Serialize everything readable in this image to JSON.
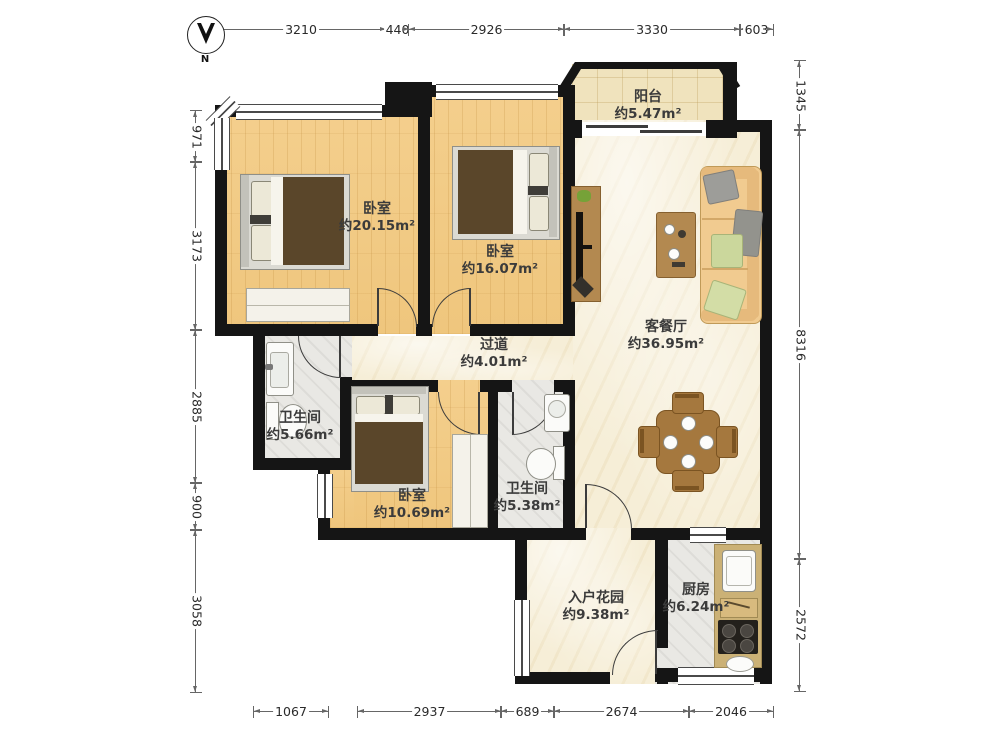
{
  "compass": {
    "label": "N"
  },
  "dimensions": {
    "top": [
      "3210",
      "440",
      "2926",
      "3330",
      "603"
    ],
    "left": [
      "971",
      "3173",
      "2885",
      "900",
      "3058"
    ],
    "right": [
      "1345",
      "8316",
      "2572"
    ],
    "bottom": [
      "1067",
      "2937",
      "689",
      "2674",
      "2046"
    ]
  },
  "rooms": [
    {
      "id": "balcony",
      "name": "阳台",
      "area": "约5.47m²"
    },
    {
      "id": "bedroom-master",
      "name": "卧室",
      "area": "约20.15m²"
    },
    {
      "id": "bedroom-second",
      "name": "卧室",
      "area": "约16.07m²"
    },
    {
      "id": "living-dining",
      "name": "客餐厅",
      "area": "约36.95m²"
    },
    {
      "id": "hallway",
      "name": "过道",
      "area": "约4.01m²"
    },
    {
      "id": "bathroom-main",
      "name": "卫生间",
      "area": "约5.66m²"
    },
    {
      "id": "bedroom-third",
      "name": "卧室",
      "area": "约10.69m²"
    },
    {
      "id": "bathroom-second",
      "name": "卫生间",
      "area": "约5.38m²"
    },
    {
      "id": "entry-garden",
      "name": "入户花园",
      "area": "约9.38m²"
    },
    {
      "id": "kitchen",
      "name": "厨房",
      "area": "约6.24m²"
    }
  ],
  "palette": {
    "wall": "#151515",
    "wood_floor": "#f3cd87",
    "marble_floor": "#f6eed7",
    "tile_beige": "#f0e3bd",
    "tile_gray": "#e9e8e4",
    "sofa": "#f1cb90",
    "furniture_wood": "#a5783e",
    "blanket_brown": "#5a462a"
  }
}
